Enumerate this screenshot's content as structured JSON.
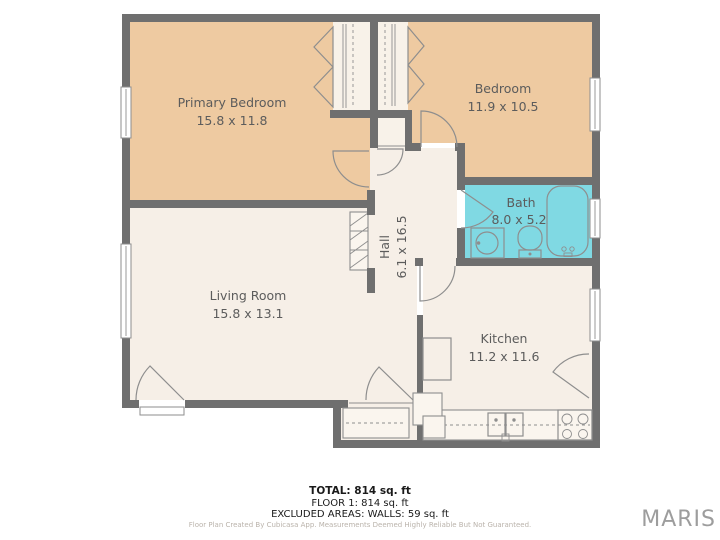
{
  "colors": {
    "wall": "#6f6f6f",
    "bedroom-fill": "#eecaa1",
    "room-fill": "#f6efe7",
    "closet-fill": "#f8f2e9",
    "bath-fill": "#80d9e3",
    "counter-fill": "#faf5ee",
    "fixture-stroke": "#8e8e8e",
    "label": "#5c5c5c",
    "summary": "#1a1a1a",
    "disclaimer": "#bab3ab",
    "watermark": "#9d9d9d"
  },
  "rooms": {
    "primary_bedroom": {
      "label": "Primary Bedroom",
      "dims": "15.8 x 11.8"
    },
    "bedroom": {
      "label": "Bedroom",
      "dims": "11.9 x 10.5"
    },
    "bath": {
      "label": "Bath",
      "dims": "8.0 x 5.2"
    },
    "hall": {
      "label": "Hall",
      "dims": "6.1 x 16.5"
    },
    "living_room": {
      "label": "Living Room",
      "dims": "15.8 x 13.1"
    },
    "kitchen": {
      "label": "Kitchen",
      "dims": "11.2 x 11.6"
    }
  },
  "summary": {
    "total": "TOTAL: 814 sq. ft",
    "floor": "FLOOR 1: 814 sq. ft",
    "excluded": "EXCLUDED AREAS: WALLS: 59 sq. ft"
  },
  "disclaimer": "Floor Plan Created By Cubicasa App. Measurements Deemed Highly Reliable But Not Guaranteed.",
  "watermark": "MARIS"
}
